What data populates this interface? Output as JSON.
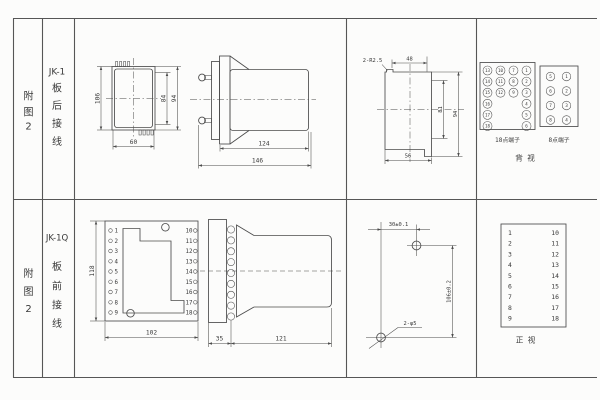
{
  "colors": {
    "line": "#4b4b4b",
    "text": "#383838",
    "background": "#fcfcfb"
  },
  "row_jk1": {
    "figure_label": [
      "附",
      "图",
      "2"
    ],
    "model": "JK-1",
    "wiring_label": [
      "板",
      "后",
      "接",
      "线"
    ],
    "front_view": {
      "overall_height": "106",
      "inner_height": "84",
      "mid_height": "94",
      "width": "60"
    },
    "side_view": {
      "body_length": "124",
      "total_length": "146"
    },
    "panel_cutout": {
      "corner_radius": "2-R2.5",
      "top_width": "48",
      "inner_height": "81",
      "outer_height": "94",
      "bottom_width": "56"
    },
    "terminals_18": {
      "label": "18点端子",
      "grid": [
        [
          "13",
          "10",
          "7",
          "1"
        ],
        [
          "14",
          "11",
          "8",
          "2"
        ],
        [
          "15",
          "12",
          "9",
          "3"
        ],
        [
          "16",
          "4"
        ],
        [
          "17",
          "5"
        ],
        [
          "18",
          "6"
        ]
      ]
    },
    "terminals_8": {
      "label": "8点端子",
      "grid": [
        [
          "5",
          "1"
        ],
        [
          "6",
          "2"
        ],
        [
          "7",
          "3"
        ],
        [
          "8",
          "4"
        ]
      ]
    },
    "view_label": "背 视"
  },
  "row_jk1q": {
    "figure_label": [
      "附",
      "图",
      "2"
    ],
    "model": "JK-1Q",
    "wiring_label": [
      "板",
      "前",
      "接",
      "线"
    ],
    "front_view": {
      "height": "118",
      "width": "102",
      "pins_left": [
        "1",
        "2",
        "3",
        "4",
        "5",
        "6",
        "7",
        "8",
        "9"
      ],
      "pins_right": [
        "10",
        "11",
        "12",
        "13",
        "14",
        "15",
        "16",
        "17",
        "18"
      ]
    },
    "side_view": {
      "plate_depth": "35",
      "body_length": "121"
    },
    "drill_plan": {
      "hole_spacing_x": "30±0.1",
      "hole_spacing_y": "106±0.2",
      "holes_label": "2-φ5"
    },
    "front_panel": {
      "pins_left": [
        "1",
        "2",
        "3",
        "4",
        "5",
        "6",
        "7",
        "8",
        "9"
      ],
      "pins_right": [
        "10",
        "11",
        "12",
        "13",
        "14",
        "15",
        "16",
        "17",
        "18"
      ],
      "view_label": "正 视"
    }
  }
}
